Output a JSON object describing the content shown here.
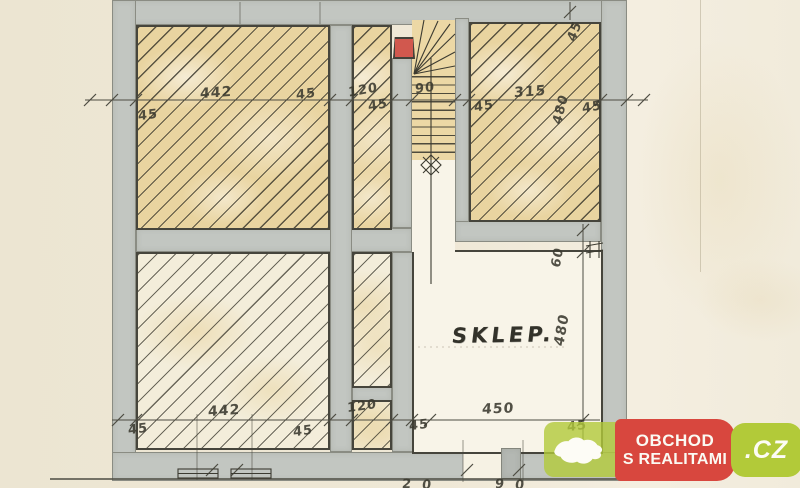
{
  "plan": {
    "room_label": "SKLEP.",
    "dim_labels": [
      {
        "text": "442",
        "x": 200,
        "y": 85,
        "rot": -4,
        "size": 14
      },
      {
        "text": "45",
        "x": 296,
        "y": 87,
        "rot": -7
      },
      {
        "text": "120",
        "x": 348,
        "y": 83,
        "rot": -10
      },
      {
        "text": "90",
        "x": 415,
        "y": 81,
        "rot": -7
      },
      {
        "text": "315",
        "x": 514,
        "y": 84,
        "rot": -4,
        "size": 14
      },
      {
        "text": "45",
        "x": 138,
        "y": 108,
        "rot": -7
      },
      {
        "text": "45",
        "x": 368,
        "y": 98,
        "rot": -10
      },
      {
        "text": "45",
        "x": 474,
        "y": 99,
        "rot": -10
      },
      {
        "text": "45",
        "x": 582,
        "y": 100,
        "rot": -10
      },
      {
        "text": "45",
        "x": 565,
        "y": 24,
        "rot": -70
      },
      {
        "text": "480",
        "x": 546,
        "y": 102,
        "rot": -76
      },
      {
        "text": "60",
        "x": 548,
        "y": 250,
        "rot": -80
      },
      {
        "text": "480",
        "x": 546,
        "y": 322,
        "rot": -80,
        "size": 14
      },
      {
        "text": "442",
        "x": 208,
        "y": 403,
        "rot": -4,
        "size": 14
      },
      {
        "text": "45",
        "x": 128,
        "y": 422,
        "rot": -7
      },
      {
        "text": "45",
        "x": 293,
        "y": 424,
        "rot": -8
      },
      {
        "text": "120",
        "x": 347,
        "y": 399,
        "rot": -8
      },
      {
        "text": "45",
        "x": 409,
        "y": 418,
        "rot": -7
      },
      {
        "text": "450",
        "x": 482,
        "y": 401,
        "rot": -2,
        "size": 14
      },
      {
        "text": "45",
        "x": 567,
        "y": 419,
        "rot": -7
      },
      {
        "text": "2",
        "x": 402,
        "y": 477,
        "rot": 0
      },
      {
        "text": "0",
        "x": 422,
        "y": 478,
        "rot": 0
      },
      {
        "text": "9",
        "x": 495,
        "y": 477,
        "rot": 0
      },
      {
        "text": "0",
        "x": 515,
        "y": 478,
        "rot": 0
      }
    ],
    "colors": {
      "wall_gray": "#c2c6c1",
      "room_fill_tan": "#e9d4a0",
      "flue_red": "#d1584e",
      "ink": "#46453c"
    }
  },
  "watermark": {
    "line1": "OBCHOD",
    "line2": "S REALITAMI",
    "tld": ".CZ",
    "green": "#b2ca39",
    "green_soft": "rgba(177,201,57,0.8)",
    "red": "#d8473e"
  }
}
